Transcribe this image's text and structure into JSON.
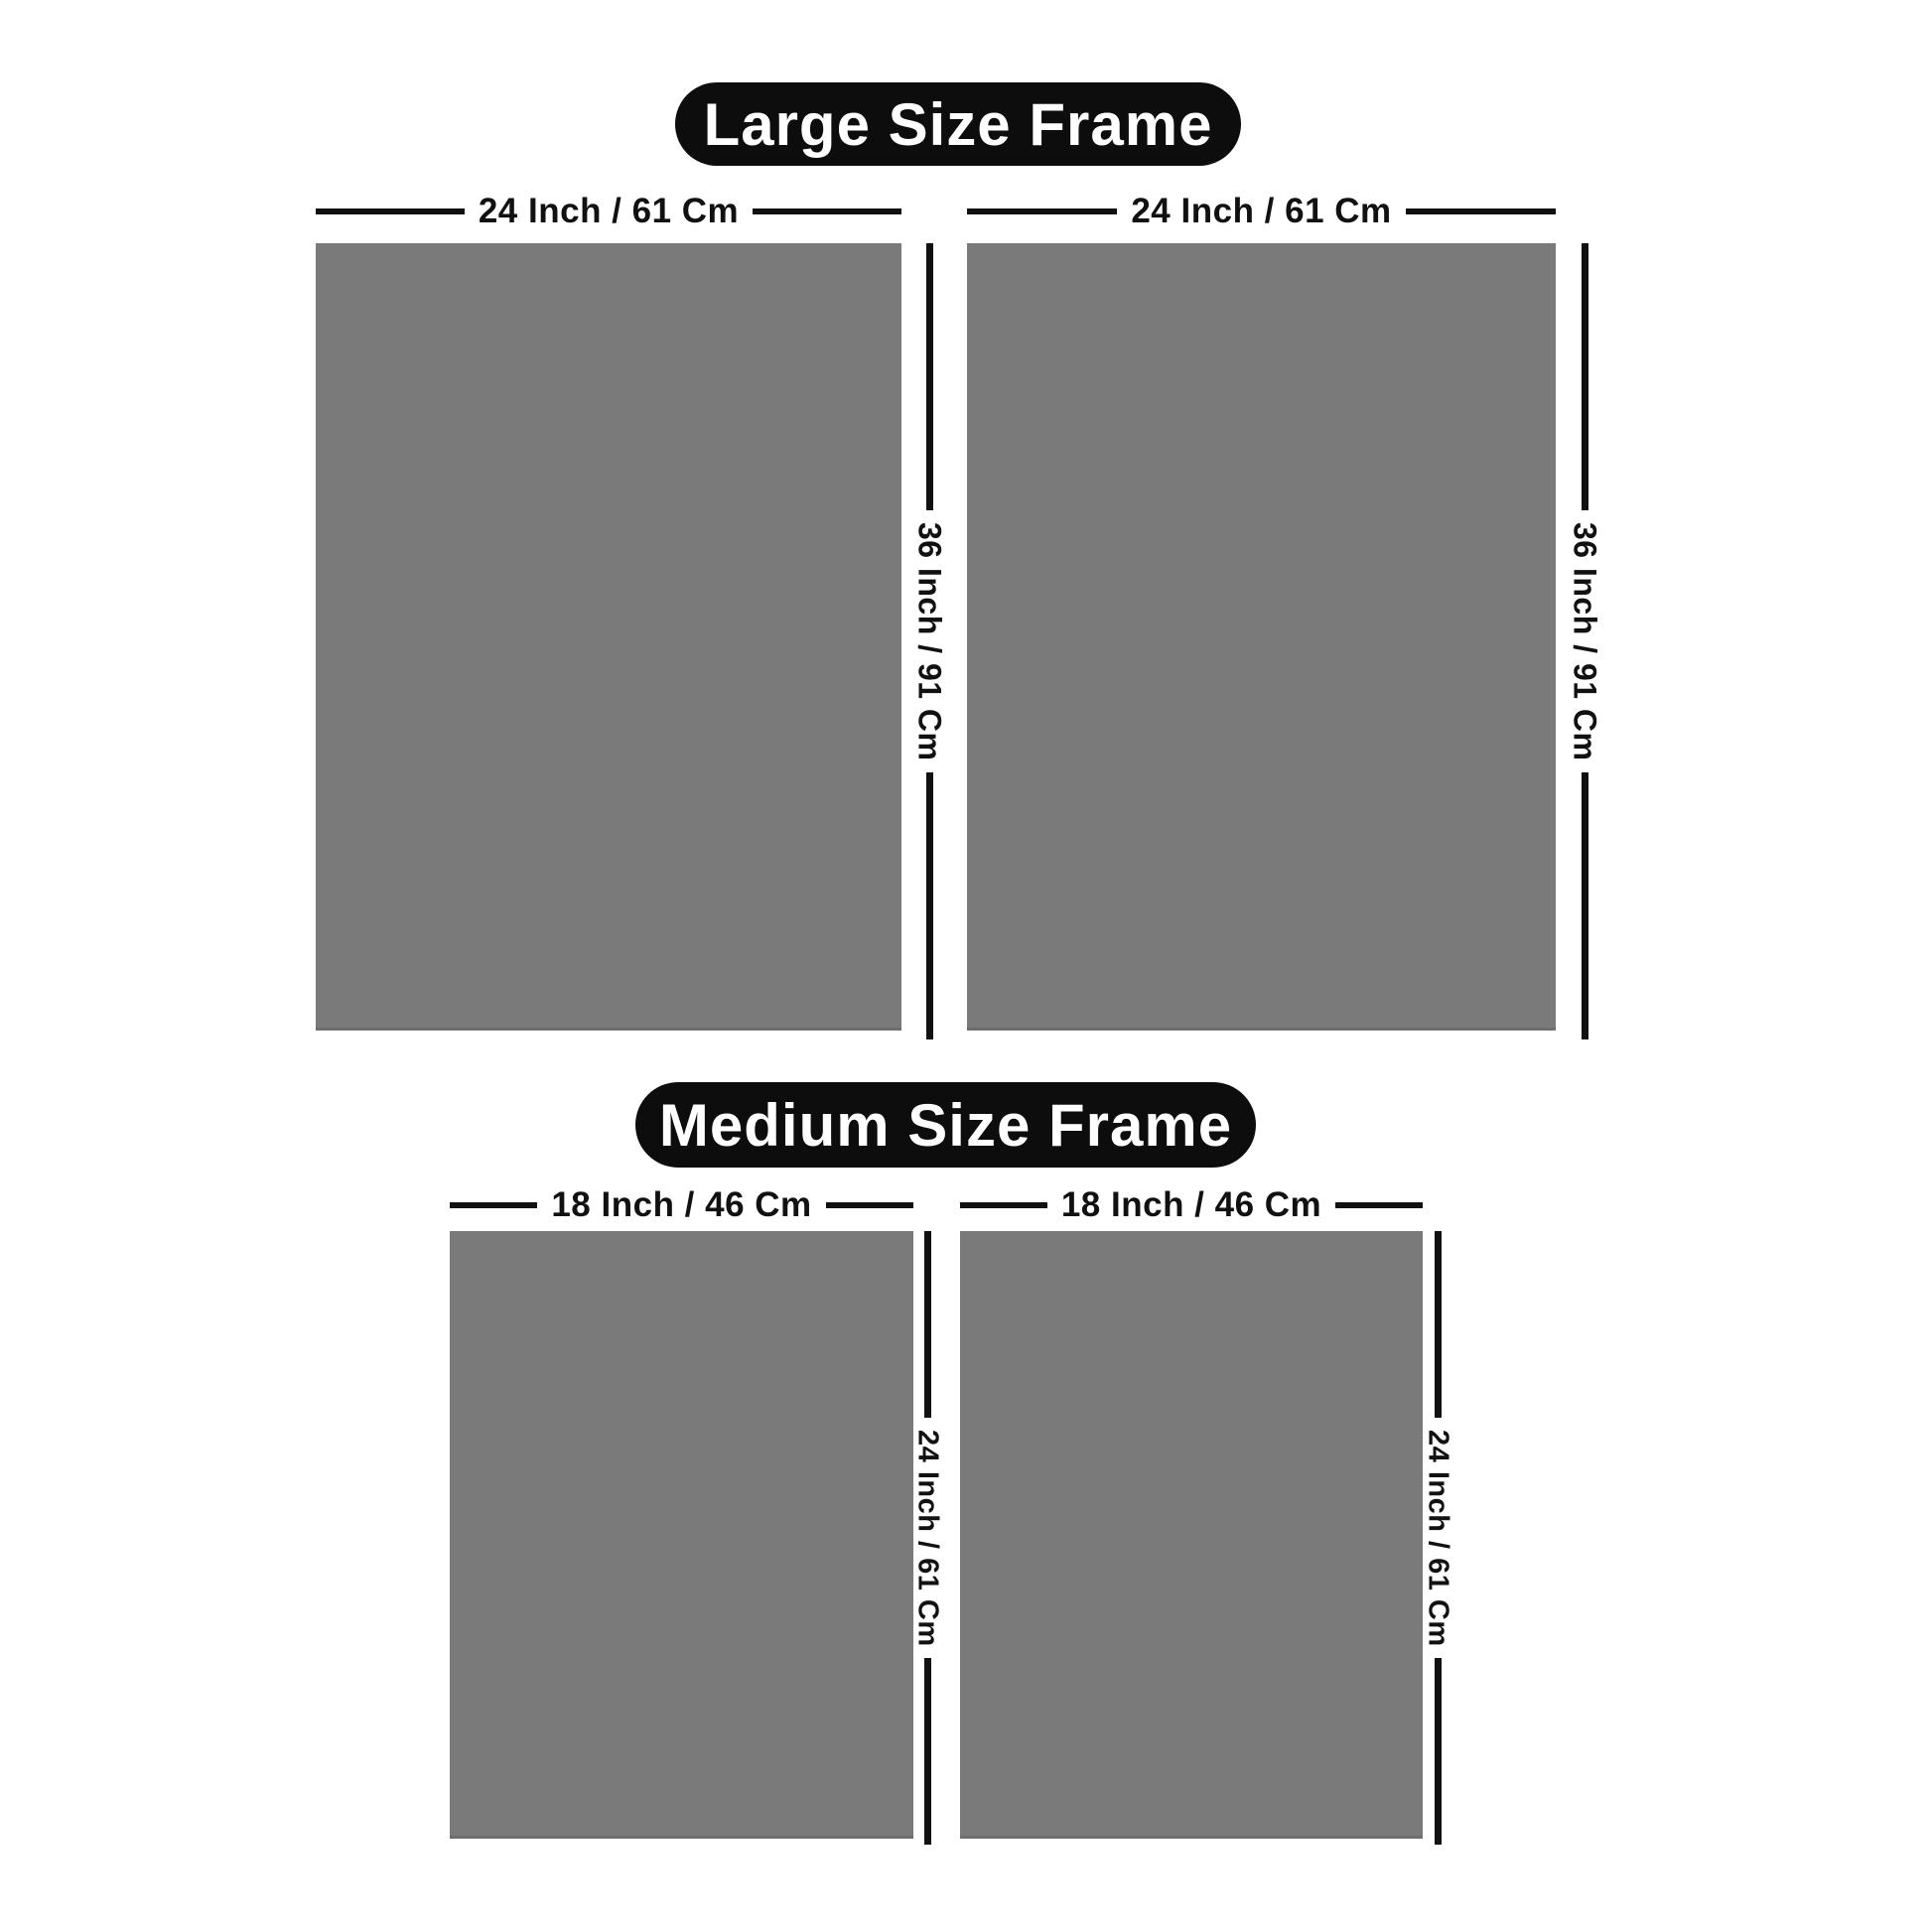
{
  "page": {
    "background": "#ffffff"
  },
  "colors": {
    "frame_fill": "#7a7a7a",
    "frame_edge": "#6e6e6e",
    "pill_bg": "#0d0d0d",
    "pill_text": "#ffffff",
    "dimension": "#111111"
  },
  "sections": [
    {
      "id": "large",
      "title": "Large Size Frame",
      "width_label": "24 Inch / 61 Cm",
      "height_label": "36 Inch / 91 Cm",
      "frame_count": 2
    },
    {
      "id": "medium",
      "title": "Medium Size Frame",
      "width_label": "18 Inch / 46 Cm",
      "height_label": "24 Inch / 61 Cm",
      "frame_count": 2
    }
  ]
}
